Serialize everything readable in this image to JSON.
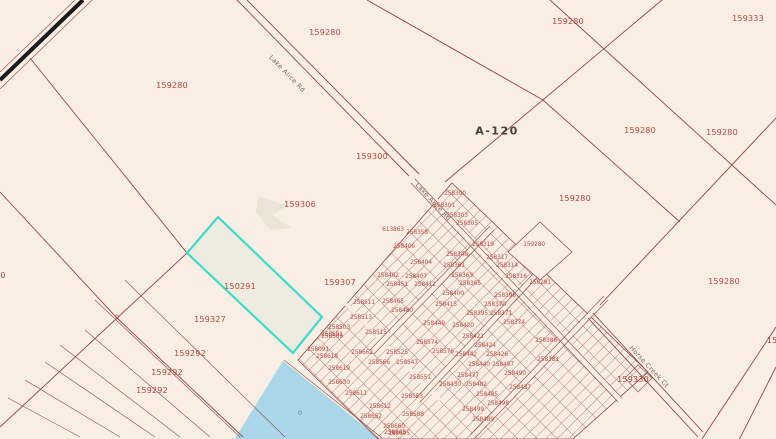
{
  "map": {
    "type": "cadastral-parcel-map",
    "selected_parcel_id": "150291",
    "section_label": "A-120",
    "colors": {
      "background": "#f8eee3",
      "parcel_line": "#8e4a45",
      "selection": "#3cdccb",
      "water": "#a9d6e8",
      "label": "#b5433c"
    },
    "labels": [
      {
        "t": "159280",
        "x": 172,
        "y": 86,
        "c": "parcel"
      },
      {
        "t": "159280",
        "x": 325,
        "y": 33,
        "c": "parcel"
      },
      {
        "t": "159280",
        "x": 568,
        "y": 22,
        "c": "parcel"
      },
      {
        "t": "159333",
        "x": 748,
        "y": 19,
        "c": "parcel"
      },
      {
        "t": "159280",
        "x": 640,
        "y": 131,
        "c": "parcel"
      },
      {
        "t": "159280",
        "x": 722,
        "y": 133,
        "c": "parcel"
      },
      {
        "t": "159280",
        "x": 575,
        "y": 199,
        "c": "parcel"
      },
      {
        "t": "159280",
        "x": 724,
        "y": 282,
        "c": "parcel"
      },
      {
        "t": "159300",
        "x": 372,
        "y": 157,
        "c": "parcel"
      },
      {
        "t": "159306",
        "x": 300,
        "y": 205,
        "c": "parcel"
      },
      {
        "t": "150291",
        "x": 240,
        "y": 287,
        "c": "parcel"
      },
      {
        "t": "159307",
        "x": 340,
        "y": 283,
        "c": "parcel"
      },
      {
        "t": "159327",
        "x": 210,
        "y": 320,
        "c": "parcel"
      },
      {
        "t": "159292",
        "x": 190,
        "y": 354,
        "c": "parcel"
      },
      {
        "t": "159292",
        "x": 167,
        "y": 373,
        "c": "parcel"
      },
      {
        "t": "159292",
        "x": 152,
        "y": 391,
        "c": "parcel"
      },
      {
        "t": "159330",
        "x": 633,
        "y": 380,
        "c": "parcel"
      },
      {
        "t": "159280",
        "x": 534,
        "y": 245,
        "c": "dense"
      },
      {
        "t": "0",
        "x": 3,
        "y": 276,
        "c": "parcel"
      },
      {
        "t": "0",
        "x": 117,
        "y": 318,
        "c": "zero"
      },
      {
        "t": "0",
        "x": 300,
        "y": 413,
        "c": "water-label"
      },
      {
        "t": "15",
        "x": 772,
        "y": 341,
        "c": "parcel"
      },
      {
        "t": "A-120",
        "x": 497,
        "y": 131,
        "c": "section"
      },
      {
        "t": "Lake Alice Rd",
        "x": 287,
        "y": 74,
        "c": "road",
        "rot": 46
      },
      {
        "t": "Lake Alice Rd",
        "x": 433,
        "y": 202,
        "c": "road",
        "rot": 47
      },
      {
        "t": "Horse Creek Ct",
        "x": 649,
        "y": 367,
        "c": "road",
        "rot": 47
      },
      {
        "t": "613863",
        "x": 393,
        "y": 230,
        "c": "dense"
      },
      {
        "t": "258358",
        "x": 417,
        "y": 233,
        "c": "dense"
      },
      {
        "t": "258406",
        "x": 404,
        "y": 247,
        "c": "dense"
      },
      {
        "t": "258404",
        "x": 421,
        "y": 263,
        "c": "dense"
      },
      {
        "t": "258402",
        "x": 388,
        "y": 276,
        "c": "dense"
      },
      {
        "t": "258407",
        "x": 416,
        "y": 277,
        "c": "dense"
      },
      {
        "t": "258451",
        "x": 397,
        "y": 285,
        "c": "dense"
      },
      {
        "t": "258412",
        "x": 425,
        "y": 285,
        "c": "dense"
      },
      {
        "t": "258465",
        "x": 393,
        "y": 302,
        "c": "dense"
      },
      {
        "t": "258480",
        "x": 402,
        "y": 311,
        "c": "dense"
      },
      {
        "t": "258415",
        "x": 446,
        "y": 305,
        "c": "dense"
      },
      {
        "t": "258449",
        "x": 434,
        "y": 324,
        "c": "dense"
      },
      {
        "t": "258400",
        "x": 453,
        "y": 294,
        "c": "dense"
      },
      {
        "t": "258361",
        "x": 454,
        "y": 266,
        "c": "dense"
      },
      {
        "t": "258363",
        "x": 462,
        "y": 276,
        "c": "dense"
      },
      {
        "t": "258365",
        "x": 470,
        "y": 284,
        "c": "dense"
      },
      {
        "t": "258348",
        "x": 457,
        "y": 255,
        "c": "dense"
      },
      {
        "t": "258319",
        "x": 483,
        "y": 245,
        "c": "dense"
      },
      {
        "t": "258317",
        "x": 497,
        "y": 258,
        "c": "dense"
      },
      {
        "t": "258314",
        "x": 507,
        "y": 266,
        "c": "dense"
      },
      {
        "t": "258316",
        "x": 516,
        "y": 277,
        "c": "dense"
      },
      {
        "t": "258281",
        "x": 540,
        "y": 283,
        "c": "dense"
      },
      {
        "t": "258398",
        "x": 505,
        "y": 296,
        "c": "dense"
      },
      {
        "t": "258370",
        "x": 495,
        "y": 305,
        "c": "dense"
      },
      {
        "t": "258395",
        "x": 477,
        "y": 314,
        "c": "dense"
      },
      {
        "t": "258371",
        "x": 501,
        "y": 314,
        "c": "dense"
      },
      {
        "t": "258374",
        "x": 514,
        "y": 323,
        "c": "dense"
      },
      {
        "t": "258420",
        "x": 463,
        "y": 326,
        "c": "dense"
      },
      {
        "t": "258300",
        "x": 455,
        "y": 194,
        "c": "dense"
      },
      {
        "t": "258301",
        "x": 444,
        "y": 206,
        "c": "dense"
      },
      {
        "t": "258303",
        "x": 457,
        "y": 216,
        "c": "dense"
      },
      {
        "t": "258305",
        "x": 467,
        "y": 224,
        "c": "dense"
      },
      {
        "t": "258511",
        "x": 364,
        "y": 303,
        "c": "dense"
      },
      {
        "t": "258513",
        "x": 361,
        "y": 318,
        "c": "dense"
      },
      {
        "t": "258503",
        "x": 339,
        "y": 328,
        "c": "dense"
      },
      {
        "t": "258509",
        "x": 332,
        "y": 337,
        "c": "dense"
      },
      {
        "t": "258515",
        "x": 376,
        "y": 333,
        "c": "dense"
      },
      {
        "t": "258591",
        "x": 332,
        "y": 335,
        "c": "dense"
      },
      {
        "t": "258091",
        "x": 318,
        "y": 350,
        "c": "dense"
      },
      {
        "t": "258618",
        "x": 327,
        "y": 357,
        "c": "dense"
      },
      {
        "t": "258619",
        "x": 339,
        "y": 369,
        "c": "dense"
      },
      {
        "t": "258630",
        "x": 339,
        "y": 383,
        "c": "dense"
      },
      {
        "t": "258611",
        "x": 356,
        "y": 394,
        "c": "dense"
      },
      {
        "t": "258612",
        "x": 380,
        "y": 407,
        "c": "dense"
      },
      {
        "t": "258652",
        "x": 371,
        "y": 417,
        "c": "dense"
      },
      {
        "t": "258660",
        "x": 394,
        "y": 427,
        "c": "dense"
      },
      {
        "t": "258665",
        "x": 395,
        "y": 433,
        "c": "dense"
      },
      {
        "t": "258662",
        "x": 362,
        "y": 353,
        "c": "dense"
      },
      {
        "t": "258525",
        "x": 397,
        "y": 353,
        "c": "dense"
      },
      {
        "t": "258566",
        "x": 379,
        "y": 363,
        "c": "dense"
      },
      {
        "t": "258547",
        "x": 407,
        "y": 363,
        "c": "dense"
      },
      {
        "t": "258551",
        "x": 420,
        "y": 378,
        "c": "dense"
      },
      {
        "t": "258553",
        "x": 412,
        "y": 397,
        "c": "dense"
      },
      {
        "t": "258588",
        "x": 413,
        "y": 415,
        "c": "dense"
      },
      {
        "t": "258605",
        "x": 399,
        "y": 434,
        "c": "dense"
      },
      {
        "t": "258574",
        "x": 427,
        "y": 343,
        "c": "dense"
      },
      {
        "t": "258576",
        "x": 443,
        "y": 352,
        "c": "dense"
      },
      {
        "t": "258421",
        "x": 473,
        "y": 337,
        "c": "dense"
      },
      {
        "t": "258424",
        "x": 485,
        "y": 346,
        "c": "dense"
      },
      {
        "t": "258442",
        "x": 466,
        "y": 355,
        "c": "dense"
      },
      {
        "t": "258426",
        "x": 497,
        "y": 355,
        "c": "dense"
      },
      {
        "t": "258440",
        "x": 479,
        "y": 365,
        "c": "dense"
      },
      {
        "t": "258497",
        "x": 503,
        "y": 365,
        "c": "dense"
      },
      {
        "t": "258477",
        "x": 468,
        "y": 376,
        "c": "dense"
      },
      {
        "t": "258490",
        "x": 515,
        "y": 374,
        "c": "dense"
      },
      {
        "t": "258430",
        "x": 450,
        "y": 385,
        "c": "dense"
      },
      {
        "t": "258482",
        "x": 476,
        "y": 385,
        "c": "dense"
      },
      {
        "t": "258437",
        "x": 520,
        "y": 388,
        "c": "dense"
      },
      {
        "t": "258485",
        "x": 487,
        "y": 395,
        "c": "dense"
      },
      {
        "t": "258498",
        "x": 498,
        "y": 404,
        "c": "dense"
      },
      {
        "t": "258499",
        "x": 473,
        "y": 410,
        "c": "dense"
      },
      {
        "t": "258489",
        "x": 483,
        "y": 420,
        "c": "dense"
      },
      {
        "t": "258386",
        "x": 546,
        "y": 341,
        "c": "dense"
      },
      {
        "t": "258381",
        "x": 548,
        "y": 360,
        "c": "dense"
      }
    ]
  }
}
